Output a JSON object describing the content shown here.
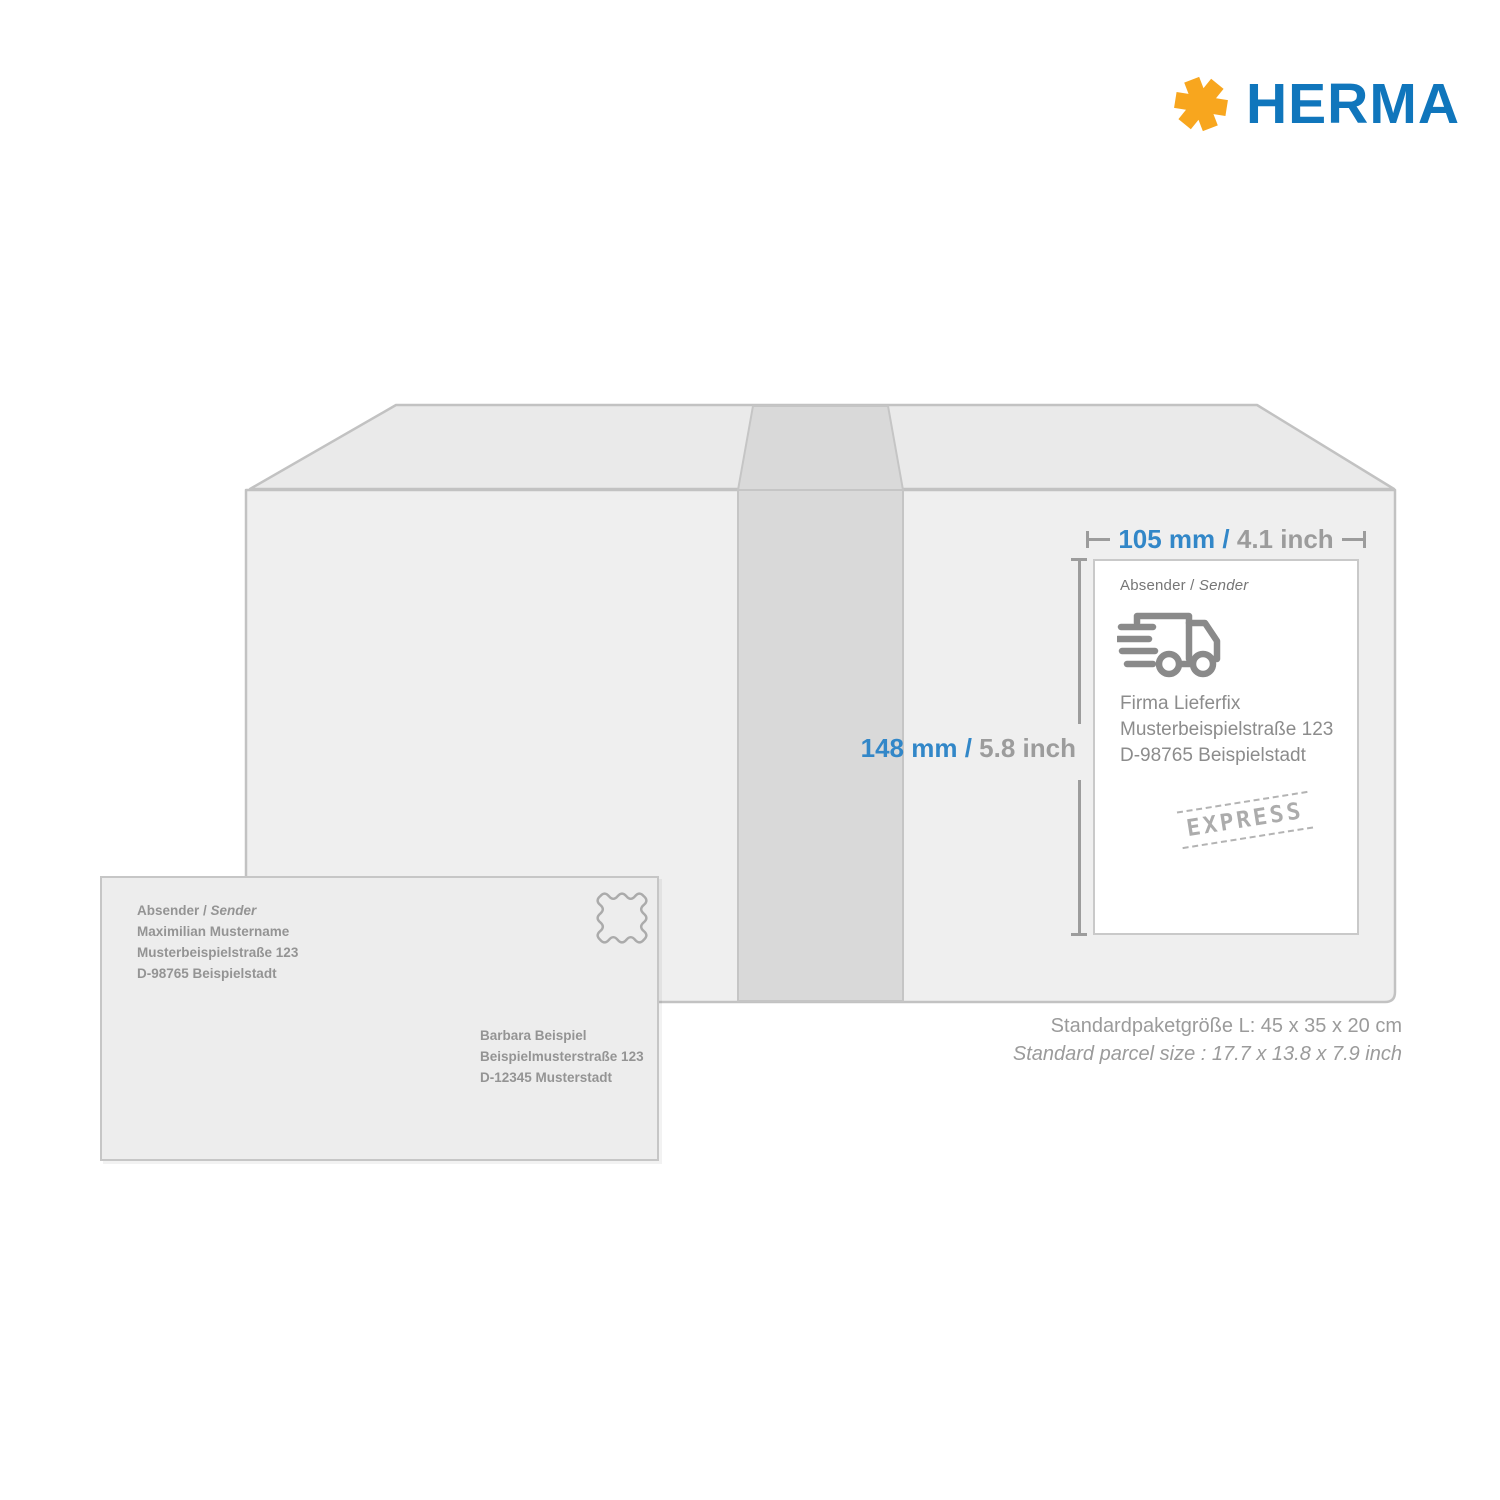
{
  "brand": {
    "wordmark": "HERMA",
    "colors": {
      "blue": "#1076BC",
      "yellow": "#F8A61E"
    }
  },
  "dimensions": {
    "width_metric": "105 mm",
    "separator": "/",
    "width_imperial": "4.1 inch",
    "height_metric": "148 mm",
    "height_imperial": "5.8 inch",
    "accent_blue": "#3287C8",
    "line_gray": "#9C9C9C"
  },
  "shipping_label": {
    "sender_prefix": "Absender /",
    "sender_word": "Sender",
    "address_lines": [
      "Firma Lieferfix",
      "Musterbeispielstraße 123",
      "D-98765 Beispielstadt"
    ],
    "stamp_text": "EXPRESS",
    "truck_icon": "delivery-truck-icon"
  },
  "envelope": {
    "sender_prefix": "Absender /",
    "sender_word": "Sender",
    "sender_lines": [
      "Maximilian Mustername",
      "Musterbeispielstraße 123",
      "D-98765 Beispielstadt"
    ],
    "recipient_lines": [
      "Barbara Beispiel",
      "Beispielmusterstraße 123",
      "D-12345 Musterstadt"
    ],
    "stamp_icon": "postage-stamp-icon"
  },
  "caption": {
    "line1": "Standardpaketgröße L: 45 x 35 x 20 cm",
    "line2": "Standard parcel size : 17.7 x 13.8 x 7.9 inch"
  }
}
